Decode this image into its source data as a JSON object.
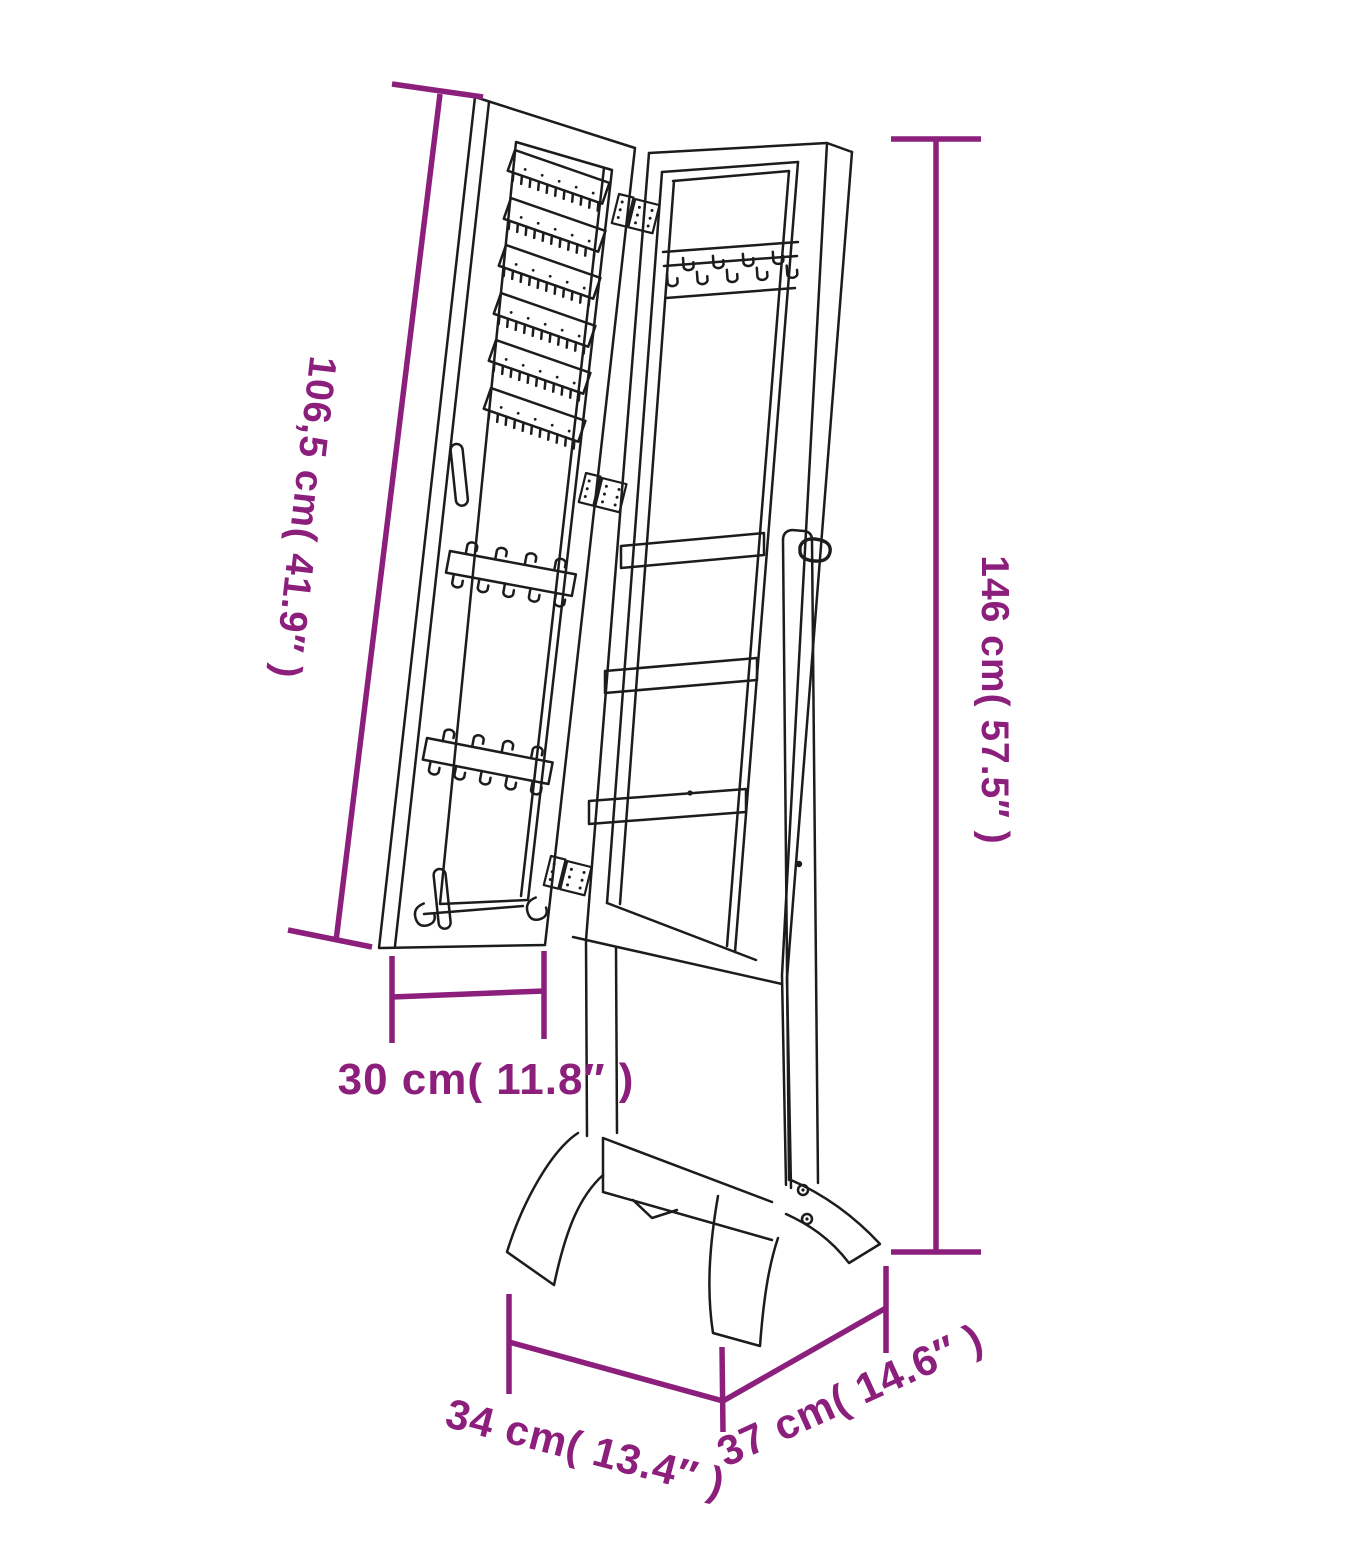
{
  "diagram": {
    "kind": "product-dimension-drawing",
    "subject": "free-standing mirror jewellery cabinet with open storage door",
    "style": {
      "accent_color": "#8c1f7c",
      "line_color": "#1c1c1c",
      "background": "#ffffff"
    },
    "dimensions": [
      {
        "id": "door-height",
        "label": "106,5 cm( 41.9″ )",
        "cm": "106,5",
        "inches": "41.9"
      },
      {
        "id": "overall-height",
        "label": "146 cm( 57.5″ )",
        "cm": "146",
        "inches": "57.5"
      },
      {
        "id": "door-width",
        "label": "30 cm( 11.8″ )",
        "cm": "30",
        "inches": "11.8"
      },
      {
        "id": "base-depth",
        "label": "34 cm( 13.4″ )",
        "cm": "34",
        "inches": "13.4"
      },
      {
        "id": "base-width",
        "label": "37 cm( 14.6″ )",
        "cm": "37",
        "inches": "14.6"
      }
    ]
  }
}
